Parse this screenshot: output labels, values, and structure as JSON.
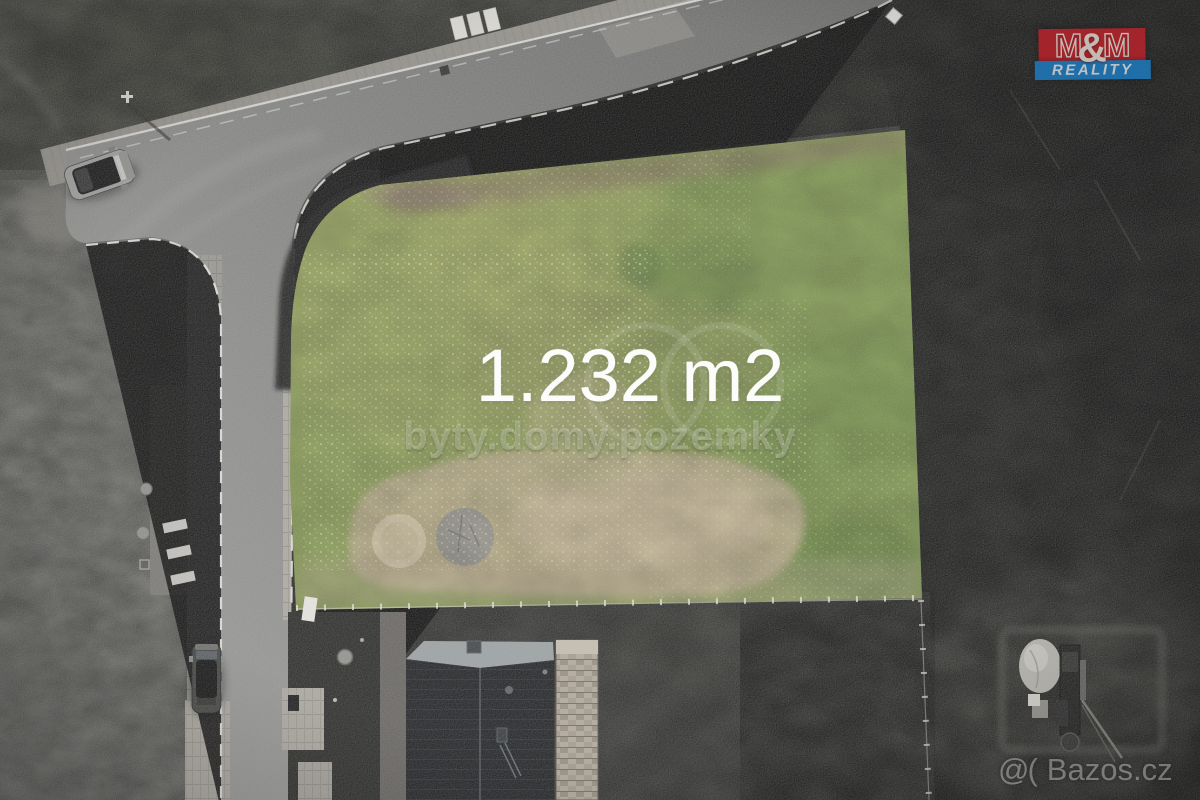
{
  "photo": {
    "kind": "aerial drone photo of a building plot for sale",
    "plot_highlight_green": "#8a9e52",
    "surroundings_style": "desaturated grayscale",
    "road_gray": "#8a8a88",
    "sand_patch_color": "#c2b08f"
  },
  "overlay": {
    "area_label": "1.232 m2",
    "center_watermark": "byty.domy.pozemky",
    "bazos_prefix": "@(",
    "bazos_name": "Bazos.cz"
  },
  "logo": {
    "brand": "M&M REALITY",
    "m_left": "M",
    "ampersand": "&",
    "m_right": "M",
    "reality_label": "REALITY",
    "red": "#b5232b",
    "blue": "#1e78ba"
  }
}
